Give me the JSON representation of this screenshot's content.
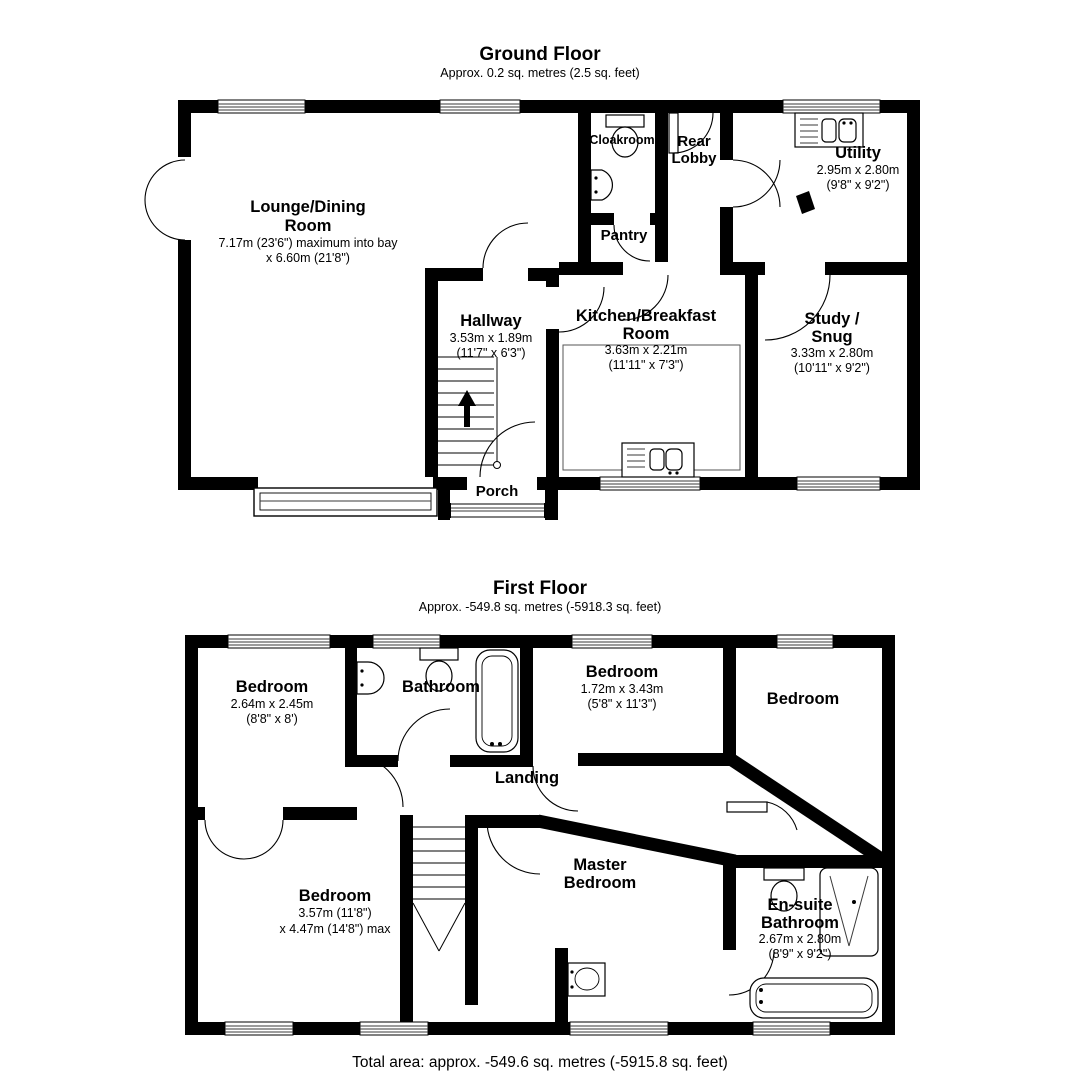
{
  "page": {
    "background": "#ffffff",
    "wall_color": "#000000"
  },
  "ground_floor": {
    "title": "Ground Floor",
    "subtitle": "Approx. 0.2 sq. metres (2.5 sq. feet)",
    "rooms": {
      "lounge": {
        "line1": "Lounge/Dining",
        "line2": "Room",
        "dim1": "7.17m (23'6\") maximum into bay",
        "dim2": "x 6.60m (21'8\")"
      },
      "cloakroom": {
        "line1": "Cloakroom"
      },
      "rear_lobby": {
        "line1": "Rear",
        "line2": "Lobby"
      },
      "utility": {
        "line1": "Utility",
        "dim1": "2.95m x 2.80m",
        "dim2": "(9'8\" x 9'2\")"
      },
      "pantry": {
        "line1": "Pantry"
      },
      "hallway": {
        "line1": "Hallway",
        "dim1": "3.53m x 1.89m",
        "dim2": "(11'7\" x 6'3\")"
      },
      "kitchen": {
        "line1": "Kitchen/Breakfast",
        "line2": "Room",
        "dim1": "3.63m x 2.21m",
        "dim2": "(11'11\" x 7'3\")"
      },
      "study": {
        "line1": "Study /",
        "line2": "Snug",
        "dim1": "3.33m x 2.80m",
        "dim2": "(10'11\" x 9'2\")"
      },
      "porch": {
        "line1": "Porch"
      }
    }
  },
  "first_floor": {
    "title": "First Floor",
    "subtitle": "Approx. -549.8 sq. metres (-5918.3 sq. feet)",
    "rooms": {
      "bedroom_top_left": {
        "line1": "Bedroom",
        "dim1": "2.64m x 2.45m",
        "dim2": "(8'8\" x 8')"
      },
      "bathroom": {
        "line1": "Bathroom"
      },
      "bedroom_middle": {
        "line1": "Bedroom",
        "dim1": "1.72m x 3.43m",
        "dim2": "(5'8\" x 11'3\")"
      },
      "bedroom_right": {
        "line1": "Bedroom"
      },
      "landing": {
        "line1": "Landing"
      },
      "bedroom_lower_left": {
        "line1": "Bedroom",
        "dim1": "3.57m (11'8\")",
        "dim2": "x 4.47m (14'8\") max"
      },
      "master_bedroom": {
        "line1": "Master",
        "line2": "Bedroom"
      },
      "ensuite": {
        "line1": "En-suite",
        "line2": "Bathroom",
        "dim1": "2.67m x 2.80m",
        "dim2": "(8'9\" x 9'2\")"
      }
    }
  },
  "footer": {
    "total_area": "Total area: approx. -549.6 sq. metres (-5915.8 sq. feet)"
  }
}
